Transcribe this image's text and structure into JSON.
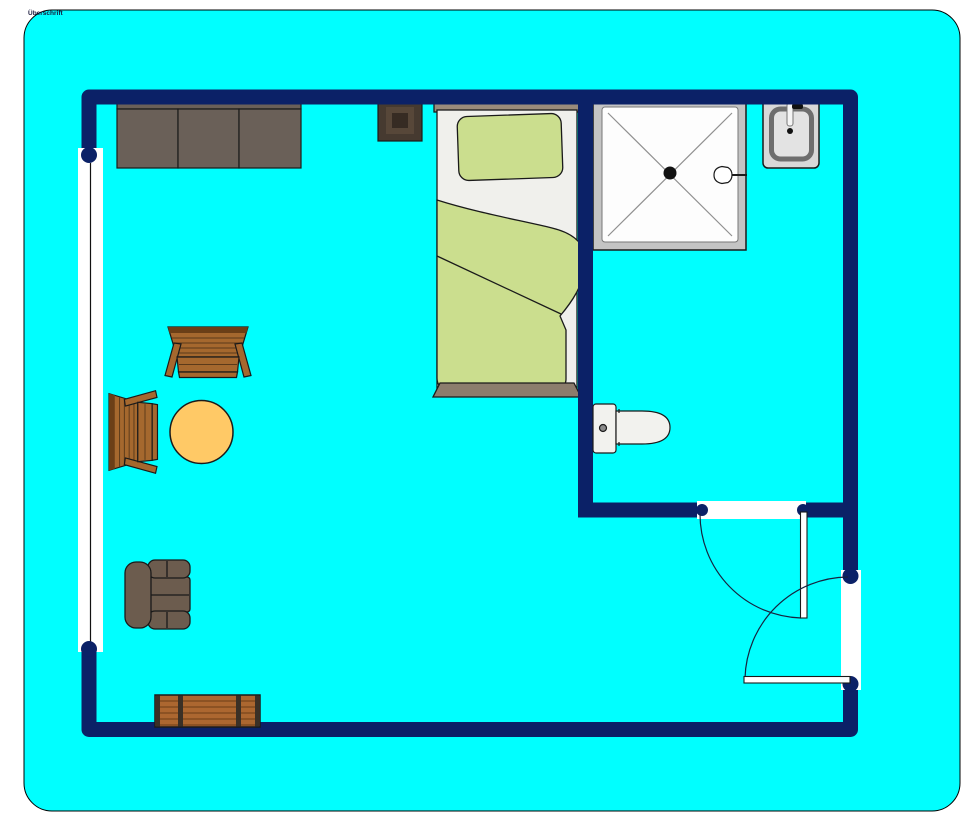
{
  "title": {
    "text": "Überschrift"
  },
  "colors": {
    "canvas_bg": "#00ffff",
    "canvas_border": "#000000",
    "wall": "#0b2167",
    "outline": "#1a1a1a",
    "opening": "#ffffff",
    "arc": "#17233f",
    "sofa": "#6a6058",
    "armchair": "#6c5c4e",
    "wood": "#a5682e",
    "wood_dark": "#5b3a1a",
    "wood_edge": "#6b3f17",
    "table_top": "#ffc966",
    "chest": "#ac6730",
    "chest_strap": "#3a3026",
    "chest_line": "#6b3e16",
    "bedding": "#cbde8e",
    "mattress": "#f0f0ec",
    "headboard": "#9a8b7b",
    "footboard": "#8c7d6d",
    "nightstand_outer": "#463a30",
    "nightstand_mid": "#574739",
    "nightstand_inner": "#362b23",
    "shower_frame": "#c4c4c4",
    "shower_floor": "#fdfdfd",
    "shower_line": "#909090",
    "fixture": "#f2f2ee",
    "sink_body": "#d8d8d8",
    "sink_rim": "#6e6e6e",
    "sink_basin": "#e3e3e3",
    "drain": "#111111",
    "metal": "#8a8a8a",
    "window_glass_line": "#111111"
  },
  "furniture": {
    "sofa": "three-seat-sofa",
    "night_table": "night-table",
    "bed": "single-bed",
    "shower": "shower-cabin",
    "sink": "wash-basin",
    "toilet": "toilet",
    "chair_top": "wooden-chair",
    "chair_left": "wooden-chair",
    "table": "round-table",
    "armchair": "armchair",
    "chest": "wooden-chest",
    "window": "window",
    "door_bathroom": "bathroom-door",
    "door_entry": "entry-door"
  }
}
